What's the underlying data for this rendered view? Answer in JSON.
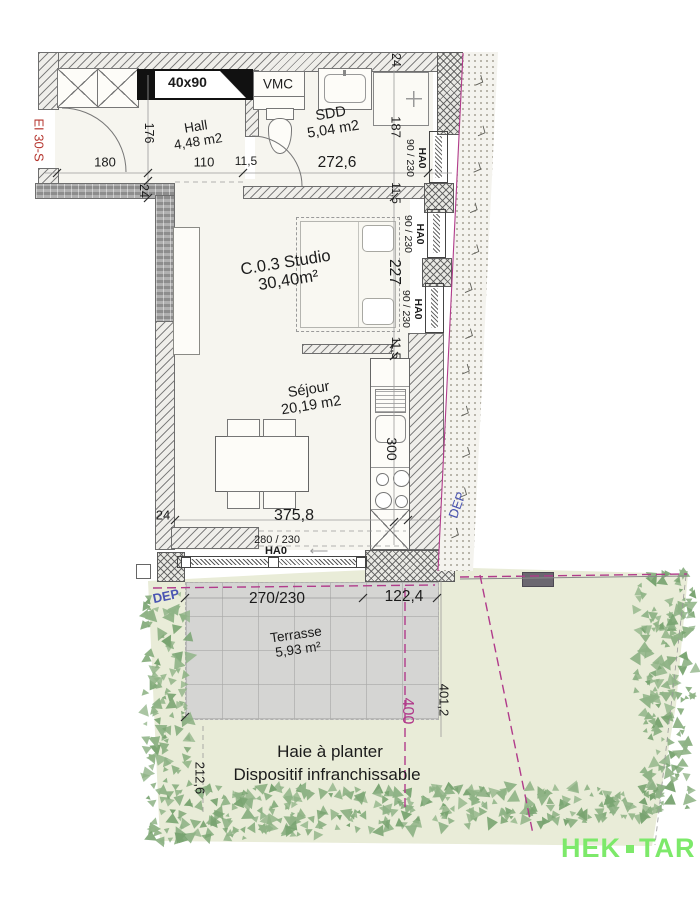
{
  "rooms": {
    "hall": {
      "name": "Hall",
      "area": "4,48 m2"
    },
    "sdd": {
      "name": "SDD",
      "area": "5,04 m2"
    },
    "studio": {
      "name": "C.0.3 Studio",
      "area": "30,40m²"
    },
    "sejour": {
      "name": "Séjour",
      "area": "20,19 m2"
    },
    "terrasse": {
      "name": "Terrasse",
      "area": "5,93 m²"
    }
  },
  "dims": {
    "hall_door": "180",
    "hall_depth": "176",
    "hall_width": "110",
    "thin_wall": "11,5",
    "sdd_width": "272,6",
    "wall24": "24",
    "sdd_depth": "187",
    "bed_span": "227",
    "kitchen_span": "300",
    "sejour_width": "375,8",
    "bay": "280 / 230",
    "terrace_bay": "270/230",
    "terrace_side": "122,4",
    "boundary400": "400",
    "boundary4012": "401,2",
    "left2126": "212,6"
  },
  "windows": {
    "tag": "HA0",
    "size": "90 / 230"
  },
  "annotations": {
    "vmc": "VMC",
    "reservation": "40x90",
    "fire_rating": "EI 30-S",
    "dep": "DEP",
    "hedge_line1": "Haie à planter",
    "hedge_line2": "Dispositif infranchissable",
    "arrow": "⟵"
  },
  "logo": {
    "left": "HEK",
    "right": "TAR"
  },
  "colors": {
    "magenta": "#b13b8b",
    "blue": "#4a55b2",
    "red": "#b5352e",
    "logo_green": "#7de96a",
    "terrain": "#e9ecd8",
    "terrace": "#d5d5d3",
    "vegetation": "#8fb386"
  }
}
